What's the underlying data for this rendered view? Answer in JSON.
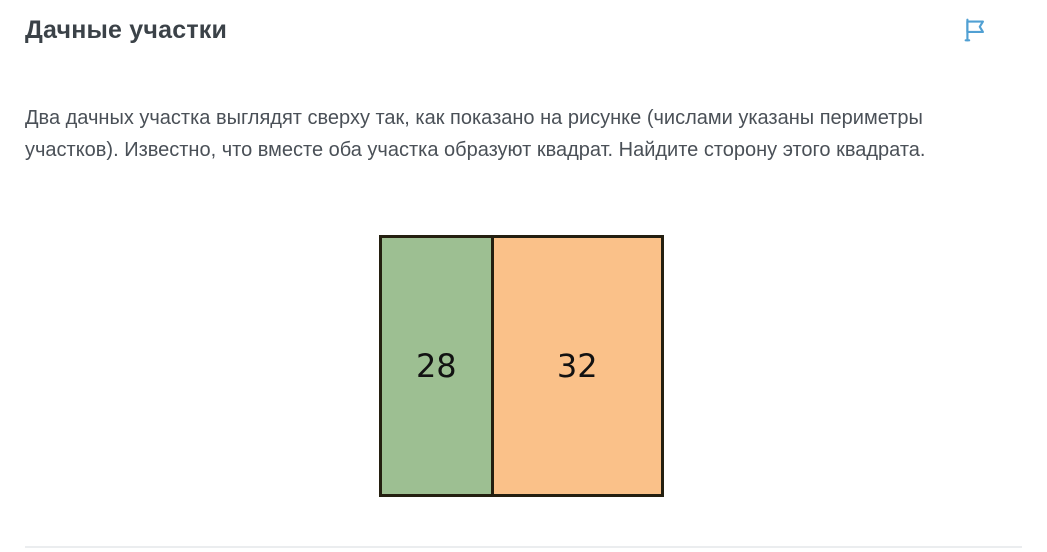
{
  "header": {
    "title": "Дачные участки",
    "flag_icon_color": "#51a0d3"
  },
  "task": {
    "text": "Два дачных участка выглядят сверху так, как показано на рисунке (числами указаны периметры участков). Известно, что вместе оба участка образуют квадрат. Найдите сторону этого квадрата."
  },
  "figure": {
    "left_plot": {
      "perimeter_label": "28",
      "fill_color": "#9dbf92"
    },
    "right_plot": {
      "perimeter_label": "32",
      "fill_color": "#fac189"
    },
    "border_color": "#241f10"
  },
  "divider_color": "#ebedef"
}
